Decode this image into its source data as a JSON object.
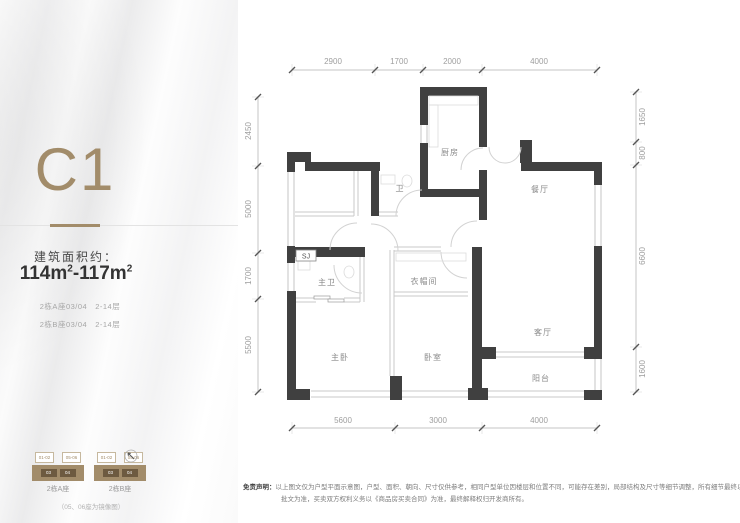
{
  "panel": {
    "unit_name": "C1",
    "area_label": "建筑面积约：",
    "area_value": {
      "p1": "114m",
      "s1": "2",
      "p2": "-117m",
      "s2": "2"
    },
    "unit_lines": [
      "2栋A座03/04　2-14层",
      "2栋B座03/04　2-14层"
    ]
  },
  "plan": {
    "rooms": {
      "kitchen": "厨房",
      "bath": "卫",
      "dining": "餐厅",
      "master_bath": "主卫",
      "closet": "衣帽间",
      "living": "客厅",
      "master_bedroom": "主卧",
      "bedroom": "卧室",
      "balcony": "阳台"
    },
    "shaft_label": "SJ",
    "dimensions": {
      "top": [
        "2900",
        "1700",
        "2000",
        "4000"
      ],
      "bottom": [
        "5600",
        "3000",
        "4000"
      ],
      "left": [
        "2450",
        "5000",
        "1700",
        "5500"
      ],
      "right": [
        "1650",
        "800",
        "6600",
        "1600"
      ]
    }
  },
  "legend": {
    "buildings": [
      {
        "label": "2栋A座",
        "upper_units": [
          "01-02",
          "05-06"
        ],
        "highlight_units": [
          "03",
          "04"
        ]
      },
      {
        "label": "2栋B座",
        "upper_units": [
          "01-02",
          "05-06"
        ],
        "highlight_units": [
          "03",
          "04"
        ]
      }
    ],
    "note": "（05、06座为镜像图）"
  },
  "disclaimer": {
    "title": "免责声明：",
    "line1": "以上图文仅为户型平面示意图，户型、面积、朝向、尺寸仅供参考，相同户型单位因楼层和位置不同，可能存在差别，局部结构及尺寸等细节调整，所有细节最终以政府",
    "line2": "批文为准，买卖双方权利义务以《商品房买卖合同》为准，最终解释权归开发商所有。"
  },
  "colors": {
    "accent": "#a28c6a",
    "wall": "#404040",
    "dim_text": "#9e9e9e"
  }
}
